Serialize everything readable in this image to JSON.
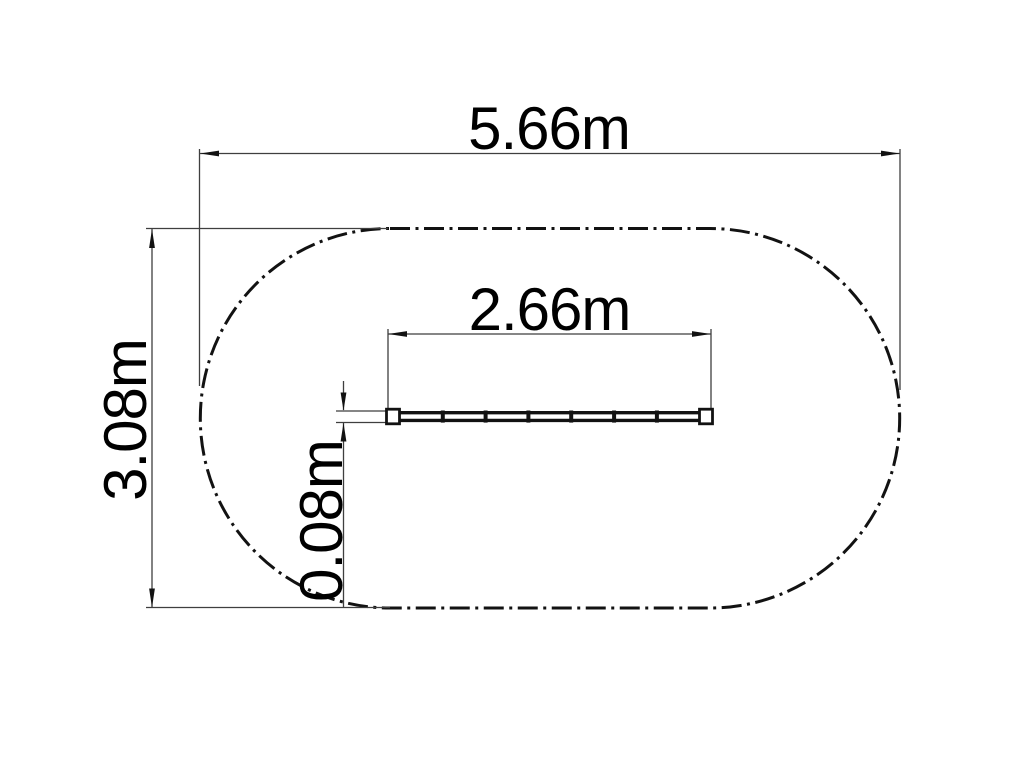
{
  "page": {
    "background": "#ffffff"
  },
  "drawing": {
    "kind": "dimensioned plan-view technical drawing",
    "colors": {
      "object_line": "#121212",
      "dimension_line": "#3f3f3f",
      "text": "#000000"
    },
    "outline": {
      "shape": "stadium",
      "line_style": "dash-dot"
    },
    "dimensions": {
      "overall_width": {
        "label": "5.66m",
        "orientation": "horizontal"
      },
      "overall_height": {
        "label": "3.08m",
        "orientation": "vertical"
      },
      "beam_length": {
        "label": "2.66m",
        "orientation": "horizontal"
      },
      "beam_width": {
        "label": "0.08m",
        "orientation": "vertical"
      }
    }
  }
}
